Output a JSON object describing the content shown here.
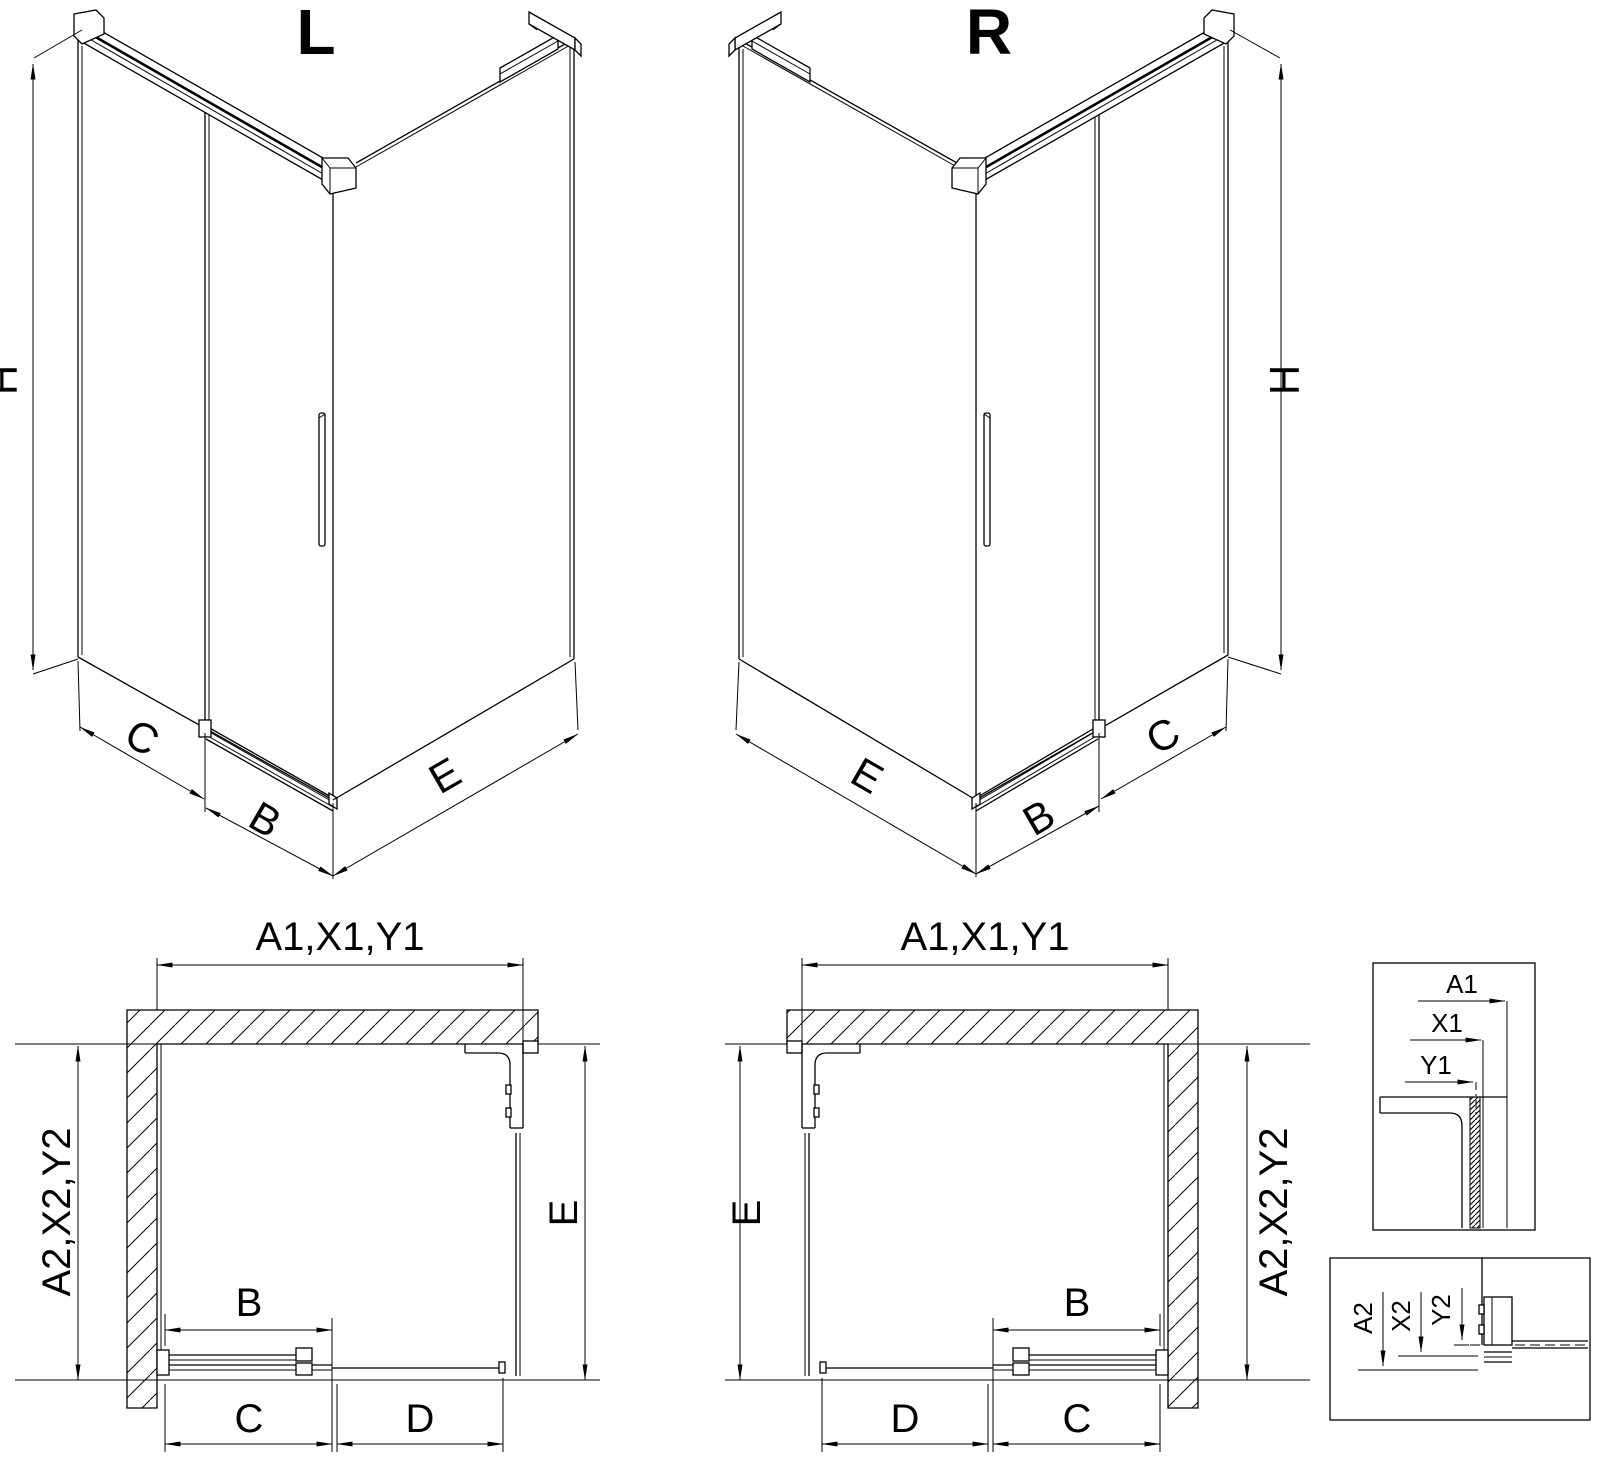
{
  "colors": {
    "line": "#000000",
    "background": "#ffffff"
  },
  "iso_left": {
    "title": "L",
    "dim_height": "H",
    "dim_side": "C",
    "dim_door": "B",
    "dim_return": "E"
  },
  "iso_right": {
    "title": "R",
    "dim_height": "H",
    "dim_side": "C",
    "dim_door": "B",
    "dim_return": "E"
  },
  "plan_left": {
    "dim_width_top": "A1,X1,Y1",
    "dim_depth_left": "A2,X2,Y2",
    "dim_return": "E",
    "dim_door": "B",
    "dim_c": "C",
    "dim_d": "D"
  },
  "plan_right": {
    "dim_width_top": "A1,X1,Y1",
    "dim_depth_right": "A2,X2,Y2",
    "dim_return": "E",
    "dim_door": "B",
    "dim_d": "D",
    "dim_c": "C"
  },
  "detail_top": {
    "dim_a": "A1",
    "dim_x": "X1",
    "dim_y": "Y1"
  },
  "detail_bottom": {
    "dim_a": "A2",
    "dim_x": "X2",
    "dim_y": "Y2"
  }
}
